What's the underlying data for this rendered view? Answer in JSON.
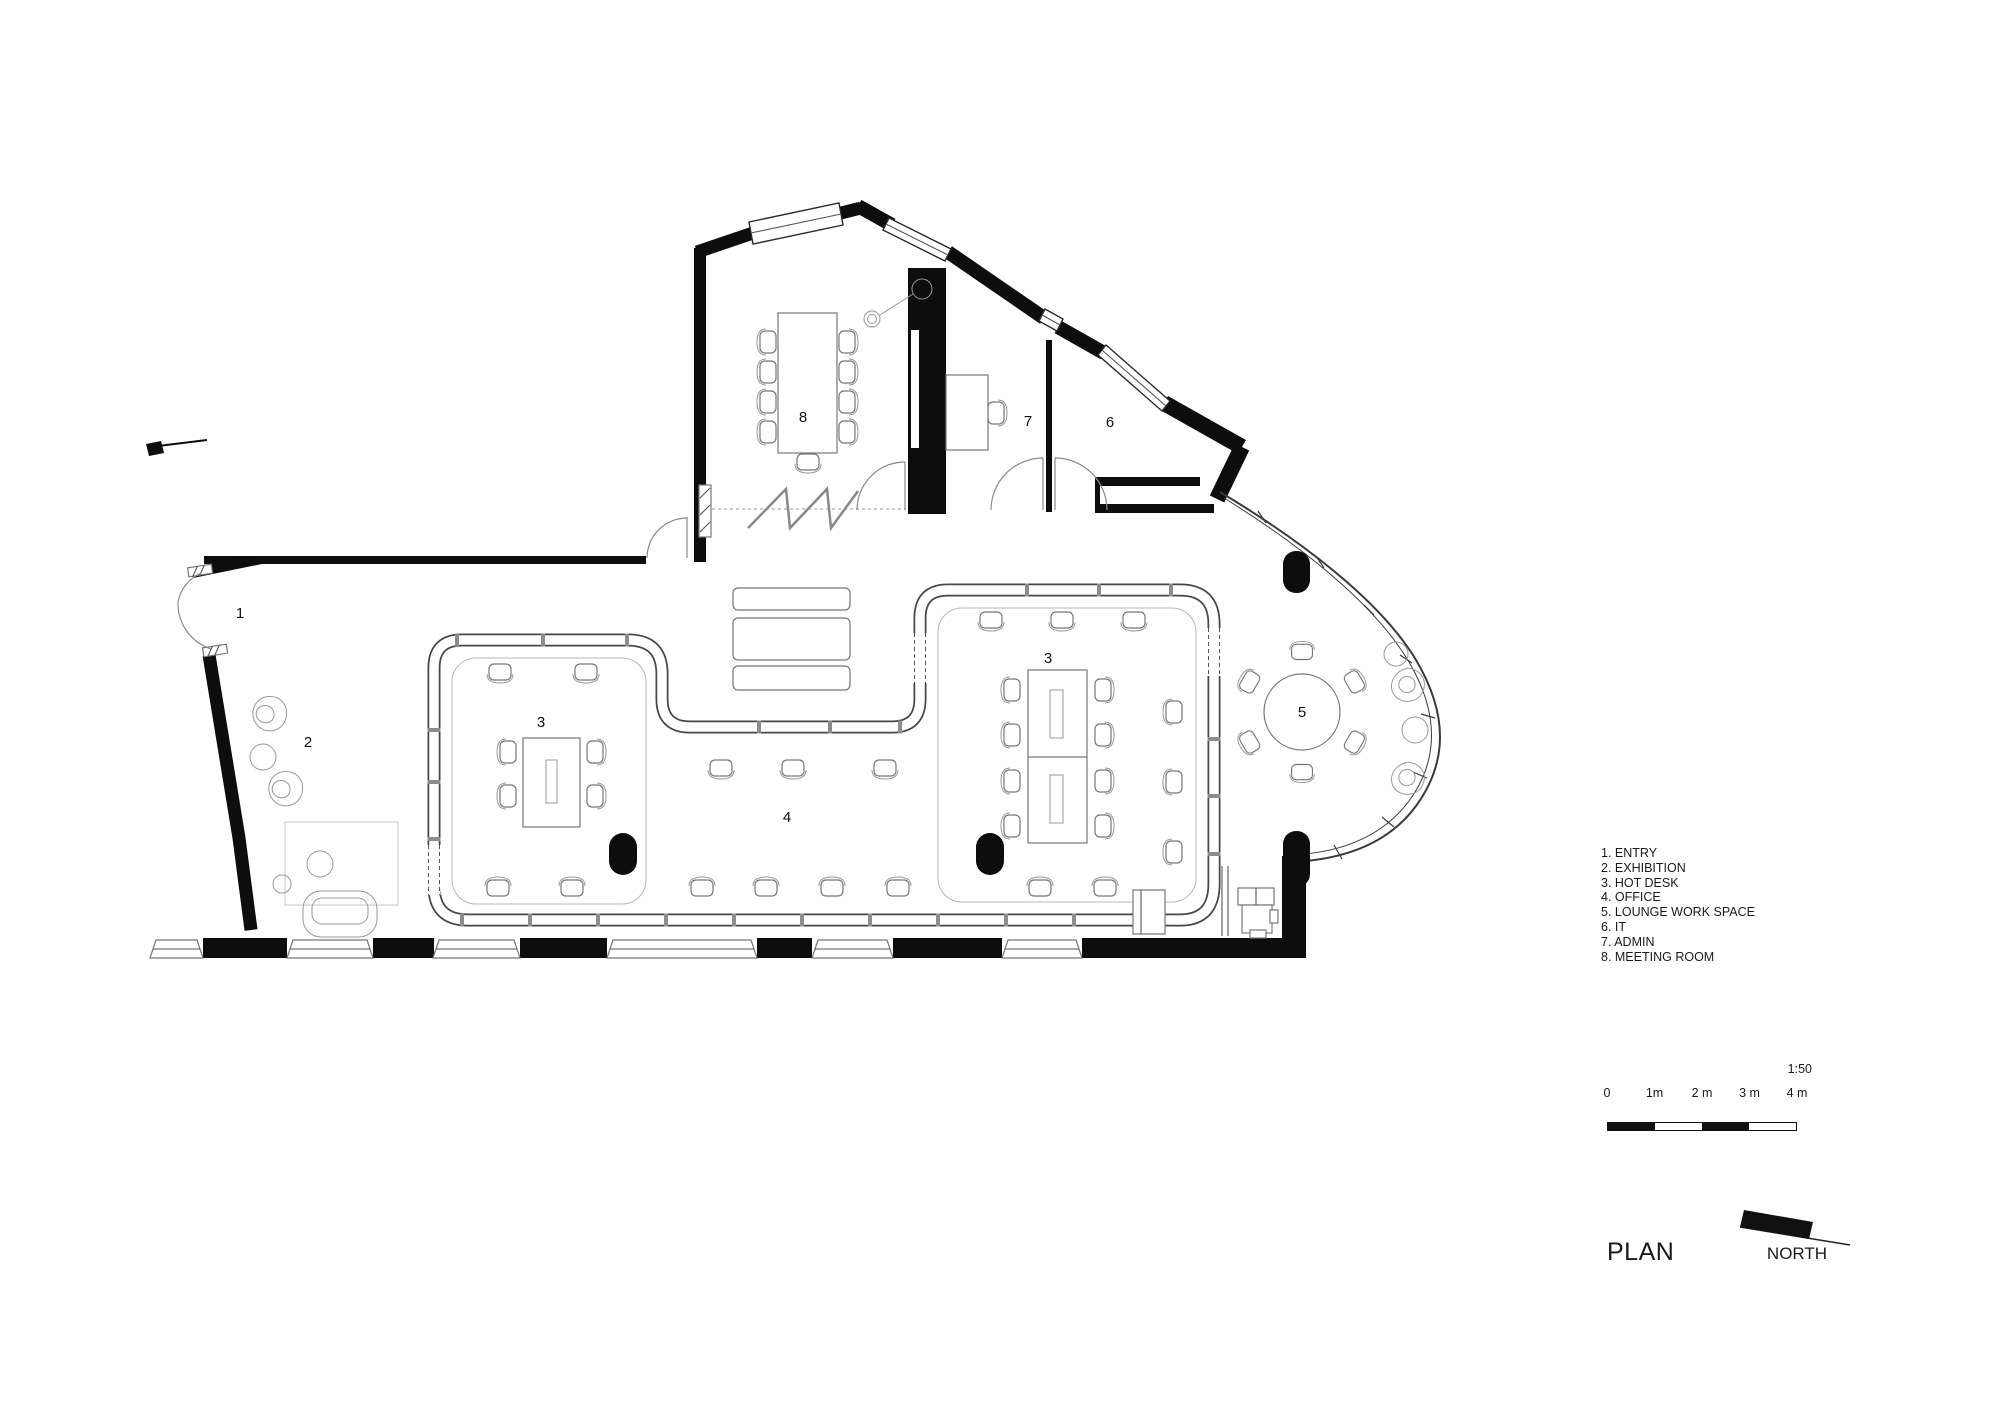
{
  "drawing": {
    "titles": {
      "plan": "PLAN",
      "north": "NORTH"
    },
    "scale": {
      "ratio": "1:50",
      "ticks": [
        "0",
        "1m",
        "2 m",
        "3 m",
        "4 m"
      ]
    },
    "legend": {
      "items": [
        "1. ENTRY",
        "2. EXHIBITION",
        "3. HOT DESK",
        "4. OFFICE",
        "5. LOUNGE WORK SPACE",
        "6. IT",
        "7. ADMIN",
        "8. MEETING ROOM"
      ]
    },
    "room_labels": [
      {
        "text": "1",
        "x": 240,
        "y": 618
      },
      {
        "text": "2",
        "x": 308,
        "y": 747
      },
      {
        "text": "3",
        "x": 541,
        "y": 727
      },
      {
        "text": "4",
        "x": 787,
        "y": 822
      },
      {
        "text": "3",
        "x": 1048,
        "y": 663
      },
      {
        "text": "5",
        "x": 1302,
        "y": 717
      },
      {
        "text": "6",
        "x": 1110,
        "y": 427
      },
      {
        "text": "7",
        "x": 1028,
        "y": 426
      },
      {
        "text": "8",
        "x": 803,
        "y": 422
      }
    ]
  }
}
